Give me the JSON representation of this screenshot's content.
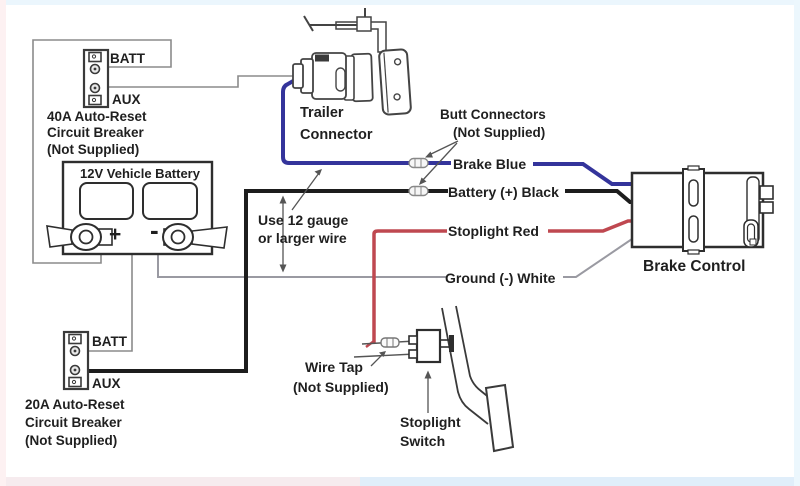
{
  "colors": {
    "wire_blue": "#34349b",
    "wire_black": "#1d1d1d",
    "wire_red": "#bf4850",
    "wire_white": "#9a9aa2",
    "wire_thin_gray": "#8b8b8b",
    "line_art": "#3a3a3a",
    "text": "#1f1f1f"
  },
  "breaker40": {
    "terminal_top": "BATT",
    "terminal_bottom": "AUX",
    "caption": [
      "40A Auto-Reset",
      "Circuit Breaker",
      "(Not Supplied)"
    ]
  },
  "breaker20": {
    "terminal_top": "BATT",
    "terminal_bottom": "AUX",
    "caption": [
      "20A Auto-Reset",
      "Circuit Breaker",
      "(Not Supplied)"
    ]
  },
  "battery": {
    "title": "12V Vehicle Battery",
    "positive": "+",
    "negative": "-"
  },
  "trailer_connector": {
    "caption": [
      "Trailer",
      "Connector"
    ]
  },
  "butt_connectors": {
    "caption": [
      "Butt Connectors",
      "(Not Supplied)"
    ]
  },
  "wire_labels": {
    "brake": "Brake Blue",
    "battery": "Battery (+) Black",
    "stoplight": "Stoplight Red",
    "ground": "Ground (-) White"
  },
  "gauge_note": {
    "caption": [
      "Use 12 gauge",
      "or larger wire"
    ]
  },
  "brake_control": {
    "label": "Brake Control"
  },
  "wire_tap": {
    "caption": [
      "Wire Tap",
      "(Not Supplied)"
    ]
  },
  "stoplight_switch": {
    "caption": [
      "Stoplight",
      "Switch"
    ]
  }
}
